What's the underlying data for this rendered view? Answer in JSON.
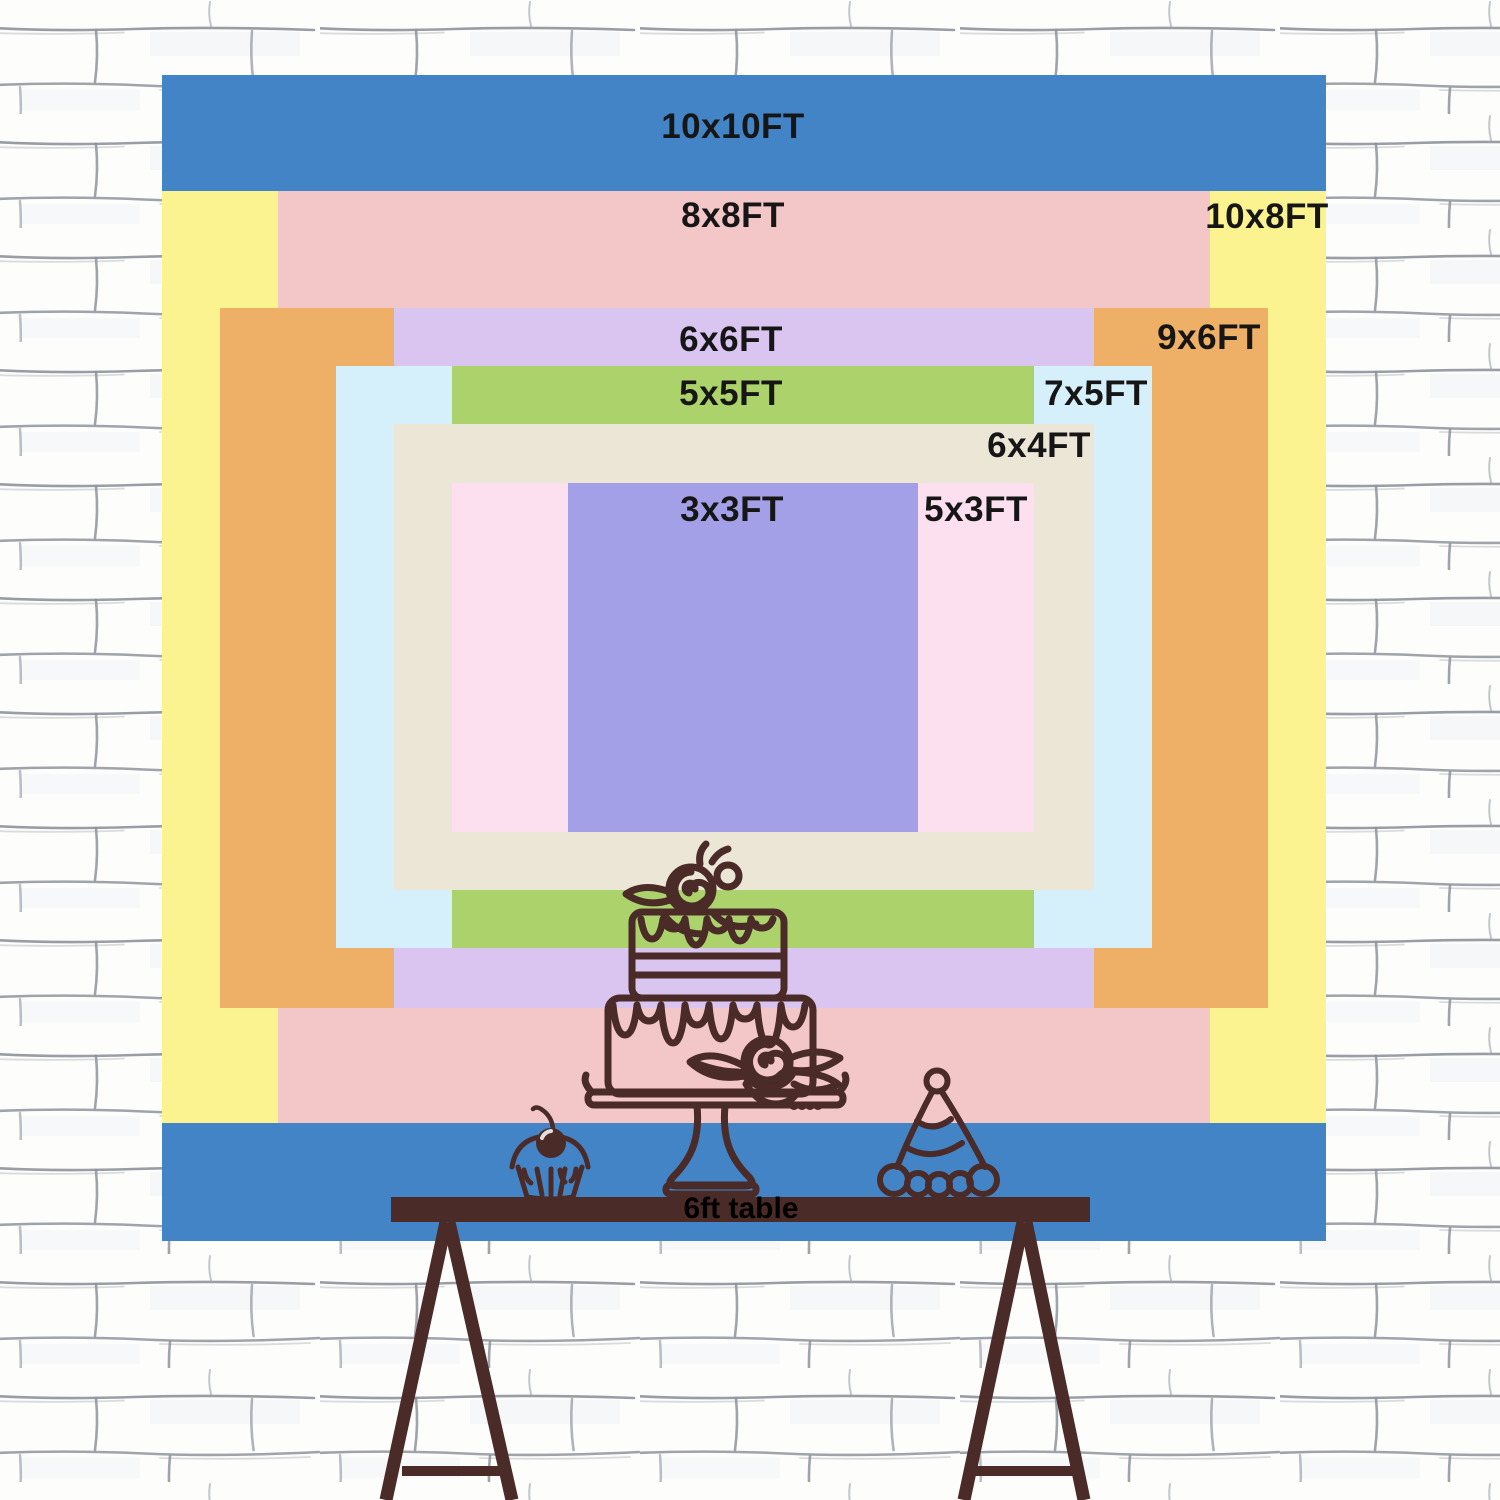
{
  "backdrop": {
    "unit": "FT",
    "label_color": "#161616",
    "sizes": [
      {
        "id": "10x10",
        "label": "10x10FT",
        "w_ft": 10,
        "h_ft": 10,
        "color": "#4284c5",
        "x": 162,
        "y": 75,
        "w": 1164,
        "h": 1166,
        "lx": 733,
        "ly": 127
      },
      {
        "id": "10x8",
        "label": "10x8FT",
        "w_ft": 10,
        "h_ft": 8,
        "color": "#fbf290",
        "x": 162,
        "y": 191,
        "w": 1164,
        "h": 932,
        "lx": 1267,
        "ly": 217
      },
      {
        "id": "8x8",
        "label": "8x8FT",
        "w_ft": 8,
        "h_ft": 8,
        "color": "#f3c6c7",
        "x": 278,
        "y": 191,
        "w": 932,
        "h": 932,
        "lx": 733,
        "ly": 216
      },
      {
        "id": "9x6",
        "label": "9x6FT",
        "w_ft": 9,
        "h_ft": 6,
        "color": "#edb066",
        "x": 220,
        "y": 308,
        "w": 1048,
        "h": 700,
        "lx": 1209,
        "ly": 338
      },
      {
        "id": "6x6",
        "label": "6x6FT",
        "w_ft": 6,
        "h_ft": 6,
        "color": "#dac5f1",
        "x": 394,
        "y": 308,
        "w": 700,
        "h": 700,
        "lx": 731,
        "ly": 340
      },
      {
        "id": "7x5",
        "label": "7x5FT",
        "w_ft": 7,
        "h_ft": 5,
        "color": "#d5f0fa",
        "x": 336,
        "y": 366,
        "w": 816,
        "h": 582,
        "lx": 1096,
        "ly": 394
      },
      {
        "id": "5x5",
        "label": "5x5FT",
        "w_ft": 5,
        "h_ft": 5,
        "color": "#acd26b",
        "x": 452,
        "y": 366,
        "w": 582,
        "h": 582,
        "lx": 731,
        "ly": 394
      },
      {
        "id": "6x4",
        "label": "6x4FT",
        "w_ft": 6,
        "h_ft": 4,
        "color": "#ebe6d6",
        "x": 394,
        "y": 424,
        "w": 700,
        "h": 466,
        "lx": 1039,
        "ly": 446
      },
      {
        "id": "5x3",
        "label": "5x3FT",
        "w_ft": 5,
        "h_ft": 3,
        "color": "#fde0f0",
        "x": 452,
        "y": 483,
        "w": 582,
        "h": 349,
        "lx": 976,
        "ly": 510
      },
      {
        "id": "3x3",
        "label": "3x3FT",
        "w_ft": 3,
        "h_ft": 3,
        "color": "#a3a0e7",
        "x": 568,
        "y": 483,
        "w": 350,
        "h": 349,
        "lx": 732,
        "ly": 510
      }
    ]
  },
  "table": {
    "label": "6ft table",
    "length_ft": 6,
    "color": "#4a2b28",
    "label_color": "#000000"
  },
  "illustrations": {
    "stroke_color": "#4a2b28",
    "items": [
      "birthday-cake",
      "cupcake",
      "party-hat"
    ]
  },
  "wall": {
    "base_color": "#fdfdfc",
    "line_color": "#878d97"
  },
  "chart_data": {
    "type": "table",
    "title": "",
    "categories": [
      "10x10FT",
      "10x8FT",
      "8x8FT",
      "9x6FT",
      "6x6FT",
      "7x5FT",
      "5x5FT",
      "6x4FT",
      "5x3FT",
      "3x3FT"
    ],
    "series": [
      {
        "name": "width_ft",
        "values": [
          10,
          10,
          8,
          9,
          6,
          7,
          5,
          6,
          5,
          3
        ]
      },
      {
        "name": "height_ft",
        "values": [
          10,
          8,
          8,
          6,
          6,
          5,
          5,
          4,
          3,
          3
        ]
      }
    ],
    "annotations": [
      "6ft table"
    ]
  }
}
